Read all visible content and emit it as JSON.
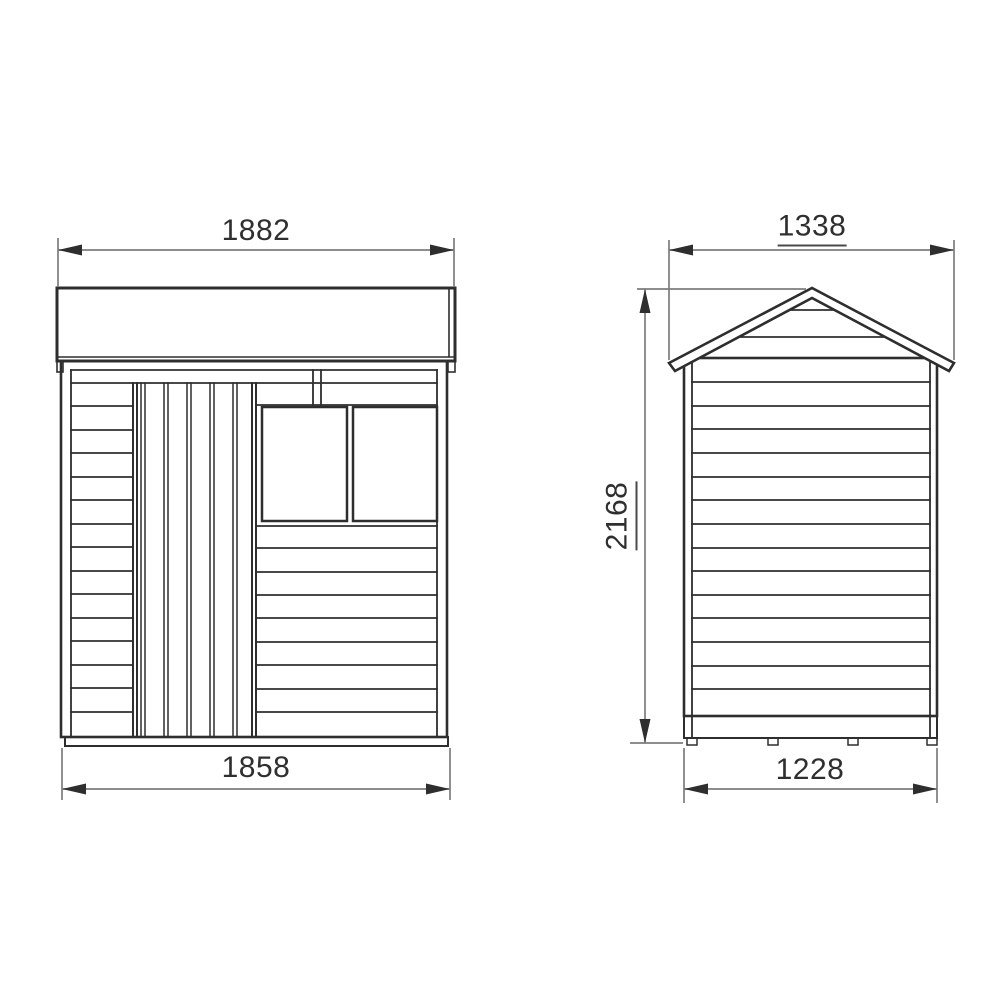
{
  "page": {
    "background_color": "#ffffff",
    "drawing_line_color": "#2e2e2e",
    "dimension_line_color": "#7d7d7d",
    "text_color": "#2f2f2f"
  },
  "drawing": {
    "front_elevation": {
      "top_width": "1882",
      "bottom_width": "1858"
    },
    "side_elevation": {
      "top_width": "1338",
      "height": "2168",
      "bottom_width": "1228"
    }
  }
}
